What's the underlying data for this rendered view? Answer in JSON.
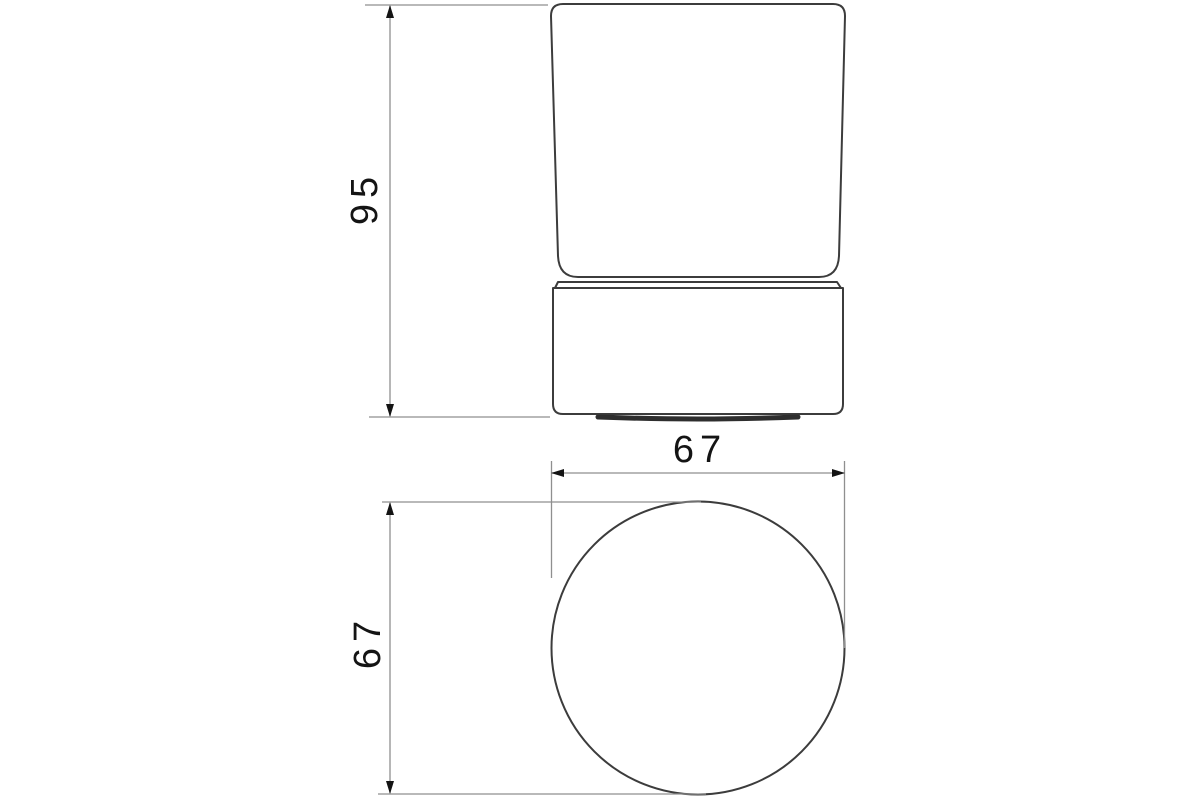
{
  "drawing": {
    "type": "technical-dimension-drawing",
    "views": {
      "front": {
        "label": "front-view-of-tumbler-with-base",
        "height_dimension": {
          "value": "95"
        }
      },
      "top": {
        "label": "top-view-circle",
        "width_dimension": {
          "value": "67"
        },
        "depth_dimension": {
          "value": "67"
        }
      }
    }
  },
  "colors": {
    "background": "#ffffff",
    "object_line": "#3c3c3c",
    "dimension_line": "#8f8f8f",
    "dimension_text": "#141414",
    "arrow": "#141414"
  }
}
